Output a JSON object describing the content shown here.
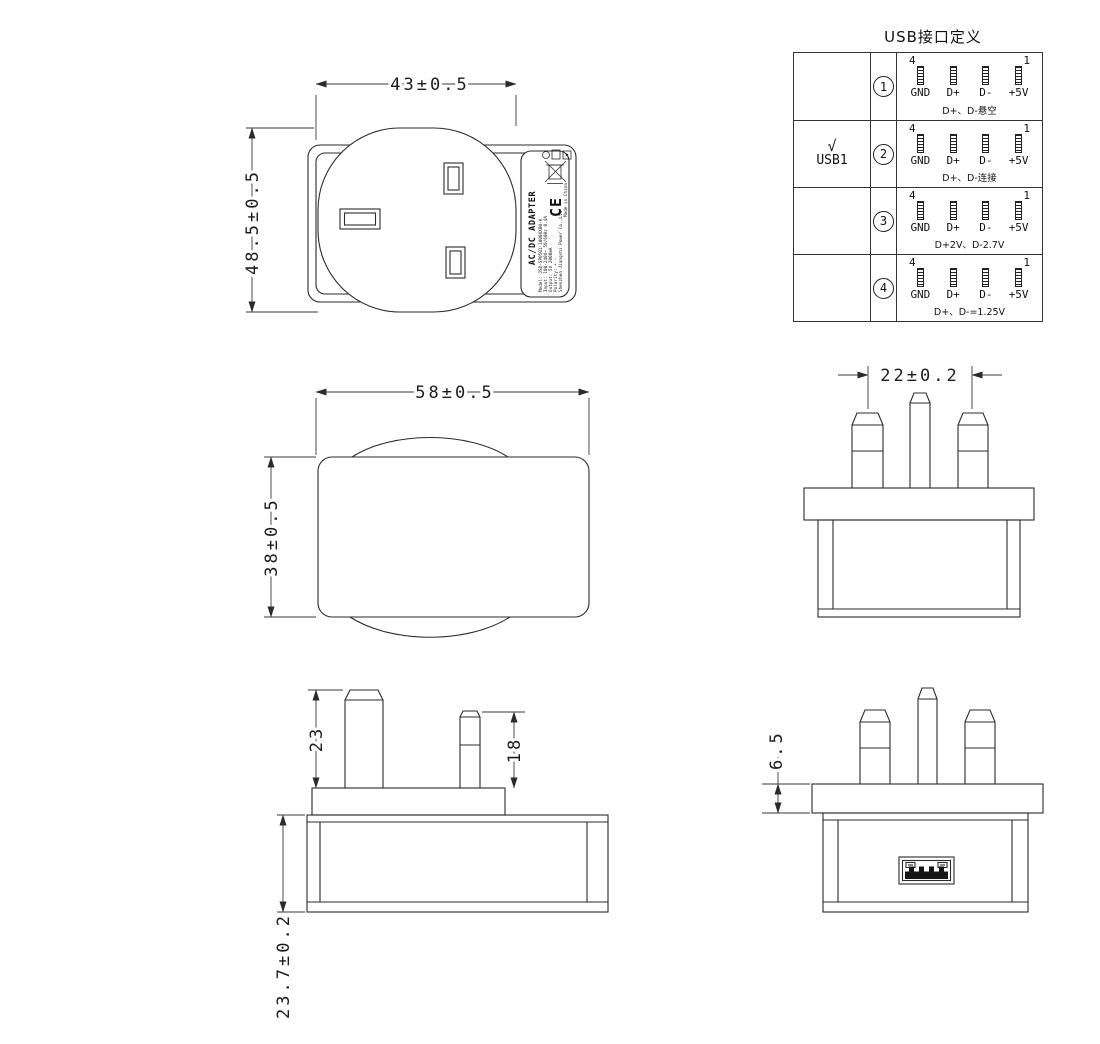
{
  "usb_table": {
    "title": "USB接口定义",
    "pin_top_left": "4",
    "pin_top_right": "1",
    "pin_labels": [
      "GND",
      "D+",
      "D-",
      "+5V"
    ],
    "rows": [
      {
        "index": "1",
        "check": "",
        "port": "",
        "note": "D+、D-悬空"
      },
      {
        "index": "2",
        "check": "√",
        "port": "USB1",
        "note": "D+、D-连接"
      },
      {
        "index": "3",
        "check": "",
        "port": "",
        "note": "D+2V、D-2.7V"
      },
      {
        "index": "4",
        "check": "",
        "port": "",
        "note": "D+、D-=1.25V"
      }
    ]
  },
  "dims": {
    "front_width": "43±0.5",
    "front_height": "48.5±0.5",
    "top_width": "58±0.5",
    "top_depth": "38±0.5",
    "pin_spacing": "22±0.2",
    "pin_long": "23",
    "pin_short": "18",
    "body_height": "23.7±0.2",
    "flange_thickness": "6.5"
  },
  "label": {
    "product": "AC/DC ADAPTER",
    "model": "Model: JSD-SP0501-1000XXB0-A",
    "input": "Input: 100-240V~ 50/60Hz 0.4A",
    "output": "Output: 5V 2000mA",
    "polarity": "Polarity: + -",
    "company": "Shenzhen Jiangshi Power Co.,Ltd",
    "ce": "CE",
    "made_in": "Made in China"
  }
}
